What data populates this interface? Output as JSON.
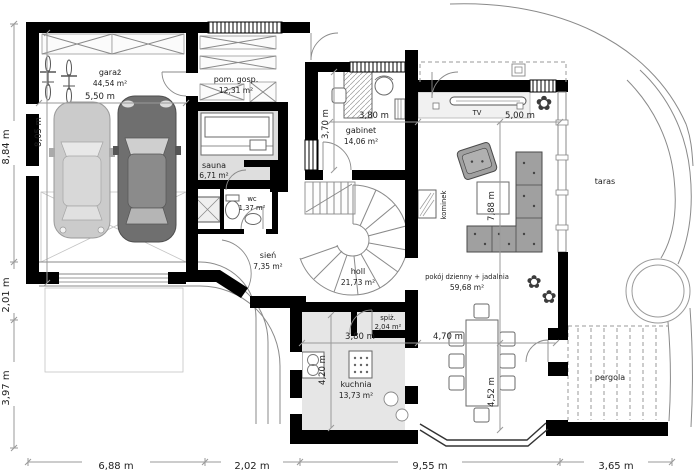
{
  "plan": {
    "title": "house ground floor plan",
    "rooms": {
      "garaz": {
        "label": "garaż",
        "area": "44,54 m²"
      },
      "pom_gosp": {
        "label": "pom. gosp.",
        "area": "12,31 m²"
      },
      "sauna": {
        "label": "sauna",
        "area": "6,71 m²"
      },
      "wc": {
        "label": "wc",
        "area": "1,37 m²"
      },
      "sien": {
        "label": "sień",
        "area": "7,35 m²"
      },
      "holl": {
        "label": "holl",
        "area": "21,73 m²"
      },
      "gabinet": {
        "label": "gabinet",
        "area": "14,06 m²"
      },
      "pokoj": {
        "label": "pokój dzienny + jadalnia",
        "area": "59,68 m²"
      },
      "kuchnia": {
        "label": "kuchnia",
        "area": "13,73 m²"
      },
      "spiz": {
        "label": "spiż.",
        "area": "2,04 m²"
      },
      "taras": {
        "label": "taras"
      },
      "pergola": {
        "label": "pergola"
      },
      "kominek": {
        "label": "kominek"
      },
      "tv": {
        "label": "TV"
      }
    },
    "dimensions": {
      "left": [
        "8,84 m",
        "2,01 m",
        "3,97 m"
      ],
      "bottom": [
        "6,88 m",
        "2,02 m",
        "9,55 m",
        "3,65 m"
      ],
      "garage_width": "5,50 m",
      "garage_height": "8,05 m",
      "gabinet_width": "3,80 m",
      "gabinet_height": "3,70 m",
      "living_width": "5,00 m",
      "living_height": "7,88 m",
      "kitchen_width": "3,80 m",
      "dining_width": "4,70 m",
      "kitchen_height": "4,20 m",
      "dining_height": "4,52 m"
    },
    "icons": {
      "plant": "✿"
    },
    "colors": {
      "wall": "#000000",
      "room_gray": "#e3e3e3",
      "furniture_gray": "#a0a0a0"
    }
  }
}
